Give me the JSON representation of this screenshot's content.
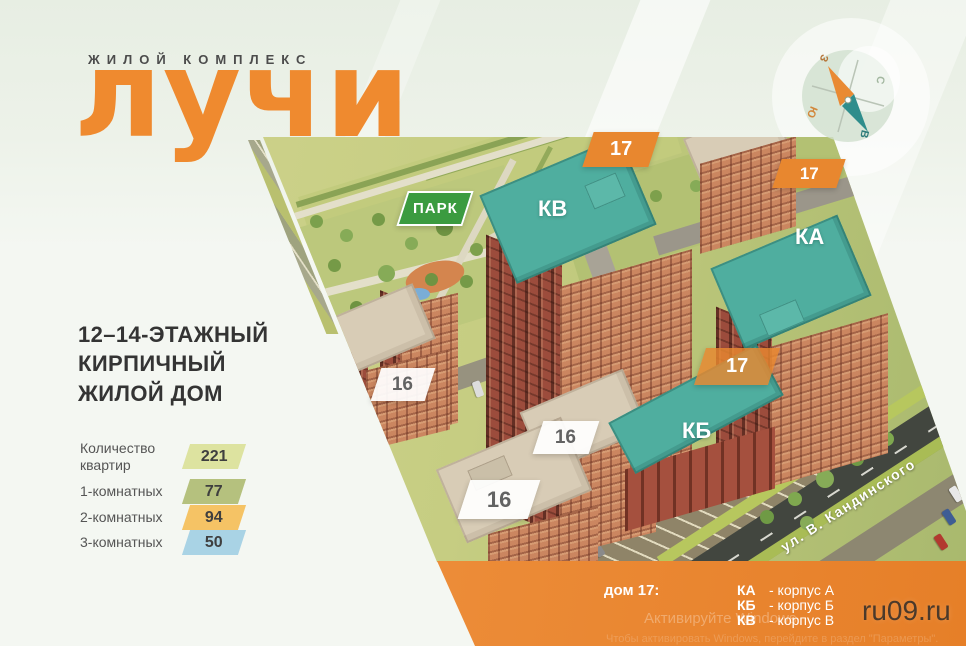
{
  "brand": {
    "subtitle": "ЖИЛОЙ КОМПЛЕКС",
    "title": "лучи"
  },
  "headline": {
    "lines": [
      "12–14-ЭТАЖНЫЙ",
      "КИРПИЧНЫЙ",
      "ЖИЛОЙ ДОМ"
    ]
  },
  "stats": {
    "rows": [
      {
        "label": "Количество квартир",
        "value": "221",
        "badge_style": "background:#dde3a0"
      },
      {
        "label": "1-комнатных",
        "value": "77",
        "badge_style": "background:#b5c17e"
      },
      {
        "label": "2-комнатных",
        "value": "94",
        "badge_style": "background:#f5c365"
      },
      {
        "label": "3-комнатных",
        "value": "50",
        "badge_style": "background:#a9d3e5"
      }
    ]
  },
  "map": {
    "park": "ПАРК",
    "street": "ул. В. Кандинского",
    "tag17": "17",
    "tag16": "16",
    "kv": "КВ",
    "ka": "КА",
    "kb": "КБ"
  },
  "compass": {
    "n": "С",
    "e": "В",
    "s": "Ю",
    "w": "З"
  },
  "legend": {
    "label": "дом 17:",
    "rows": [
      {
        "code": "КА",
        "name": "- корпус А"
      },
      {
        "code": "КБ",
        "name": "- корпус Б"
      },
      {
        "code": "КВ",
        "name": "- корпус В"
      }
    ]
  },
  "watermarks": {
    "site": "ru09.ru",
    "activate_line1": "Активируйте Windows",
    "activate_line2": "Чтобы активировать Windows, перейдите в раздел \"Параметры\"."
  },
  "colors": {
    "brand_orange": "#ef8a2f",
    "tag_orange": "#e8872f",
    "bar_orange": "#ec8c38",
    "roof_teal": "#4fae9f",
    "park_green": "#3b9b40",
    "badge_yellow": "#dde3a0",
    "badge_olive": "#b5c17e",
    "badge_amber": "#f5c365",
    "badge_blue": "#a9d3e5"
  }
}
